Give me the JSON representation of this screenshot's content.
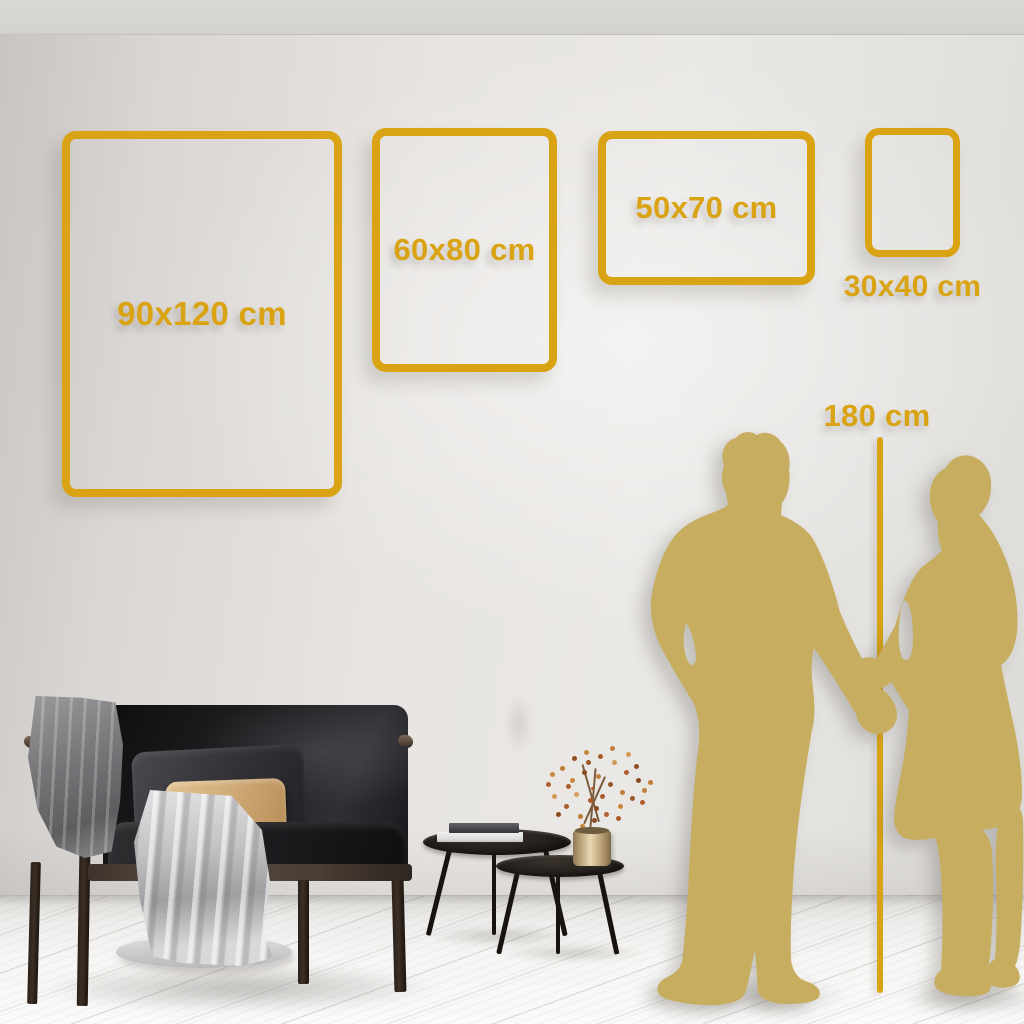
{
  "scene": {
    "accent_color": "#D9A313",
    "silhouette_color": "#C6AD60",
    "frames": [
      {
        "label": "90x120 cm"
      },
      {
        "label": "60x80 cm"
      },
      {
        "label": "50x70 cm"
      },
      {
        "label": "30x40 cm"
      }
    ],
    "height_marker": {
      "label": "180 cm"
    }
  }
}
